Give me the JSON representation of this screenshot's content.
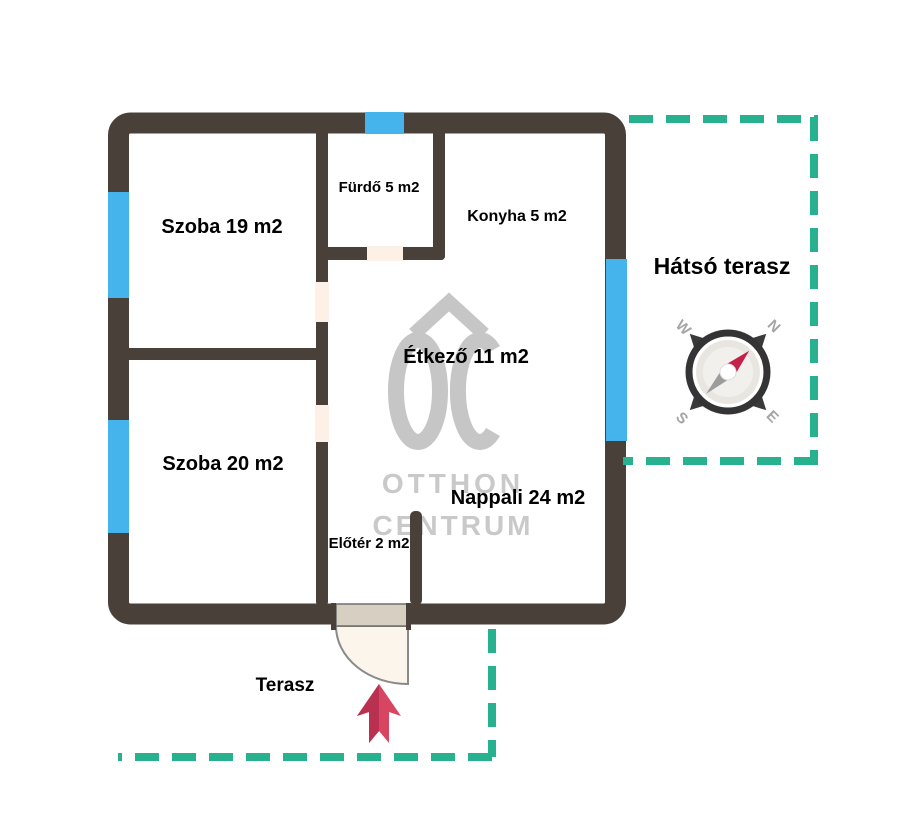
{
  "rooms": {
    "szoba19": "Szoba 19 m2",
    "szoba20": "Szoba 20 m2",
    "furdo": "Fürdő 5 m2",
    "konyha": "Konyha 5 m2",
    "etkezo": "Étkező 11 m2",
    "nappali": "Nappali 24 m2",
    "eloter": "Előtér 2 m2"
  },
  "outdoor": {
    "hatso_terasz": "Hátsó terasz",
    "terasz": "Terasz"
  },
  "compass": {
    "n": "N",
    "e": "E",
    "s": "S",
    "w": "W"
  },
  "watermark": {
    "logo": "OC",
    "line1": "OTTHON",
    "line2": "CENTRUM"
  },
  "colors": {
    "wall": "#4a403a",
    "window": "#45b4ec",
    "terrace_dash": "#28b18f",
    "arrow_light": "#d84560",
    "arrow_dark": "#b93050",
    "compass_needle_red": "#c42049",
    "compass_needle_gray": "#9c9c9c",
    "door_leaf": "#d8cfc3",
    "door_swing": "#fcf5ec",
    "door_opening": "#fdf1e7",
    "watermark_gray": "#c6c6c6",
    "label_text": "#000000"
  }
}
